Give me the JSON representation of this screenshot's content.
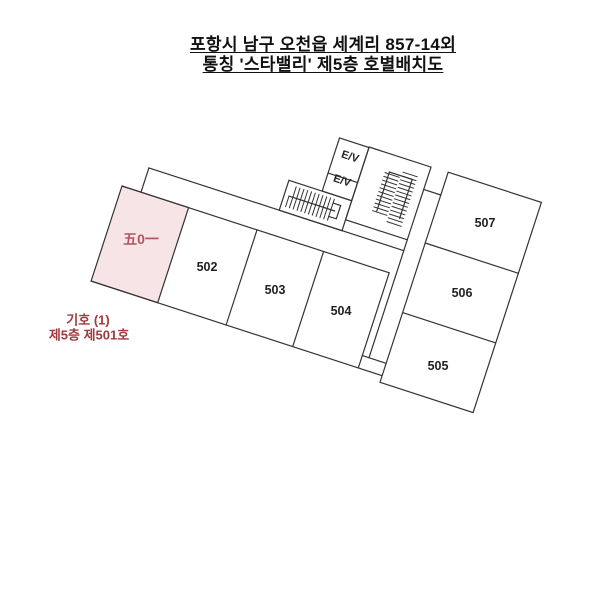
{
  "title": {
    "line1": "포항시 남구 오천읍 세계리 857-14외",
    "line2": "통칭 '스타밸리' 제5층 호별배치도"
  },
  "plan": {
    "unit_highlight": {
      "label": "五0一"
    },
    "units": {
      "u502": "502",
      "u503": "503",
      "u504": "504",
      "u505": "505",
      "u506": "506",
      "u507": "507"
    },
    "elevators": {
      "ev1": "E/V",
      "ev2": "E/V"
    },
    "annotation": {
      "line1": "기호 (1)",
      "line2": "제5층 제501호"
    },
    "colors": {
      "highlight_fill": "#f7e4e6",
      "highlight_text": "#b0565c",
      "annotation_text": "#a03a3f",
      "wall": "#333333"
    }
  }
}
